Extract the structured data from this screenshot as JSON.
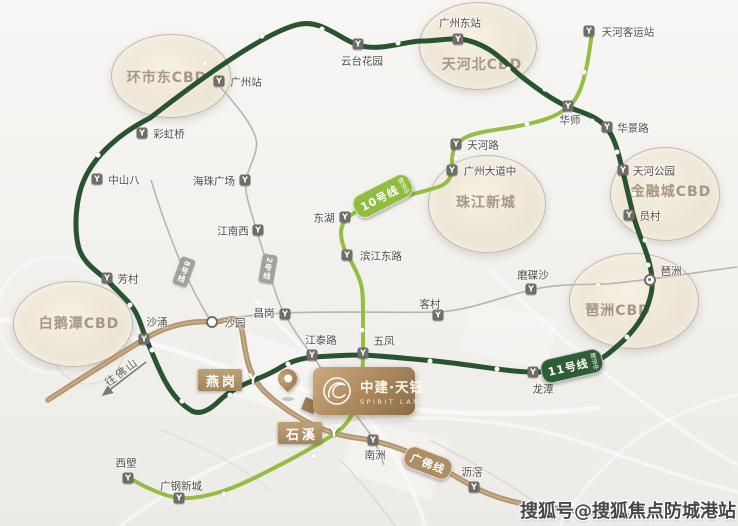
{
  "watermark": "搜狐号@搜狐焦点防城港站",
  "direction_label": "往佛山",
  "project": {
    "name_cn": "中建·天钰",
    "name_en": "SPIRIT LAND"
  },
  "colors": {
    "line_loop": "#2a5430",
    "line_light_green": "#96bd43",
    "line_brown": "#b29670",
    "line_brown_hi": "#cfb289",
    "line_gray": "#b7b5b1",
    "arrow_gray": "#7b7975",
    "zone_text": "#a89786",
    "station_icon_bg": "#6f6d68",
    "badge_line10_bg": "#8fbc41",
    "badge_line11_bg": "#2e5d36",
    "badge_guangfo_bg": "#ad8e64",
    "badge_gray_bg": "#a3a19d",
    "badge_station_bg": "#b29a6e"
  },
  "cbd_zones": [
    {
      "label": "环市东CBD",
      "cx": 170,
      "cy": 75,
      "rx": 59,
      "ry": 41,
      "lx": 167,
      "ly": 77
    },
    {
      "label": "天河北CBD",
      "cx": 477,
      "cy": 45,
      "rx": 58,
      "ry": 43,
      "lx": 482,
      "ly": 64
    },
    {
      "label": "珠江新城",
      "cx": 486,
      "cy": 203,
      "rx": 58,
      "ry": 48,
      "lx": 486,
      "ly": 202
    },
    {
      "label": "金融城CBD",
      "cx": 664,
      "cy": 193,
      "rx": 54,
      "ry": 46,
      "lx": 671,
      "ly": 191
    },
    {
      "label": "琶洲CBD",
      "cx": 633,
      "cy": 300,
      "rx": 64,
      "ry": 47,
      "lx": 618,
      "ly": 310
    },
    {
      "label": "白鹅潭CBD",
      "cx": 72,
      "cy": 323,
      "rx": 59,
      "ry": 42,
      "lx": 79,
      "ly": 323
    }
  ],
  "stations": [
    {
      "label": "广州站",
      "icon": "metro",
      "ix": 219,
      "iy": 81,
      "lx": 246,
      "ly": 82
    },
    {
      "label": "云台花园",
      "icon": "metro",
      "ix": 358,
      "iy": 44,
      "lx": 362,
      "ly": 61
    },
    {
      "label": "广州东站",
      "icon": "metro",
      "ix": 458,
      "iy": 39,
      "lx": 460,
      "ly": 23
    },
    {
      "label": "天河客运站",
      "icon": "metro",
      "ix": 589,
      "iy": 31,
      "lx": 628,
      "ly": 32
    },
    {
      "label": "华师",
      "icon": "metro",
      "ix": 568,
      "iy": 106,
      "lx": 570,
      "ly": 120
    },
    {
      "label": "华景路",
      "icon": "metro",
      "ix": 607,
      "iy": 127,
      "lx": 633,
      "ly": 128
    },
    {
      "label": "天河公园",
      "icon": "metro",
      "ix": 623,
      "iy": 170,
      "lx": 654,
      "ly": 171
    },
    {
      "label": "员村",
      "icon": "metro",
      "ix": 629,
      "iy": 215,
      "lx": 650,
      "ly": 216
    },
    {
      "label": "天河路",
      "icon": "metro",
      "ix": 456,
      "iy": 144,
      "lx": 483,
      "ly": 145
    },
    {
      "label": "广州大道中",
      "icon": "metro",
      "ix": 452,
      "iy": 170,
      "lx": 490,
      "ly": 171
    },
    {
      "label": "东湖",
      "icon": "metro",
      "ix": 345,
      "iy": 217,
      "lx": 324,
      "ly": 218
    },
    {
      "label": "滨江东路",
      "icon": "metro",
      "ix": 347,
      "iy": 255,
      "lx": 381,
      "ly": 256
    },
    {
      "label": "彩虹桥",
      "icon": "metro",
      "ix": 142,
      "iy": 133,
      "lx": 169,
      "ly": 134
    },
    {
      "label": "中山八",
      "icon": "metro",
      "ix": 97,
      "iy": 179,
      "lx": 124,
      "ly": 180
    },
    {
      "label": "海珠广场",
      "icon": "metro",
      "ix": 245,
      "iy": 180,
      "lx": 214,
      "ly": 181
    },
    {
      "label": "江南西",
      "icon": "metro",
      "ix": 258,
      "iy": 230,
      "lx": 233,
      "ly": 231
    },
    {
      "label": "芳村",
      "icon": "metro",
      "ix": 107,
      "iy": 278,
      "lx": 128,
      "ly": 279
    },
    {
      "label": "沙涌",
      "icon": "metro",
      "ix": 144,
      "iy": 339,
      "lx": 157,
      "ly": 322
    },
    {
      "label": "沙园",
      "icon": "ring",
      "ix": 212,
      "iy": 322,
      "lx": 235,
      "ly": 323
    },
    {
      "label": "昌岗",
      "icon": "metro",
      "ix": 285,
      "iy": 314,
      "lx": 264,
      "ly": 313
    },
    {
      "label": "江泰路",
      "icon": "metro",
      "ix": 312,
      "iy": 355,
      "lx": 321,
      "ly": 340
    },
    {
      "label": "五凤",
      "icon": "metro",
      "ix": 363,
      "iy": 353,
      "lx": 384,
      "ly": 341
    },
    {
      "label": "客村",
      "icon": "metro",
      "ix": 438,
      "iy": 315,
      "lx": 430,
      "ly": 304
    },
    {
      "label": "磨碟沙",
      "icon": "metro",
      "ix": 531,
      "iy": 289,
      "lx": 533,
      "ly": 275
    },
    {
      "label": "琶洲",
      "icon": "ring-dot",
      "ix": 650,
      "iy": 280,
      "lx": 671,
      "ly": 271
    },
    {
      "label": "龙潭",
      "icon": "metro",
      "ix": 533,
      "iy": 372,
      "lx": 543,
      "ly": 389
    },
    {
      "label": "南洲",
      "icon": "metro",
      "ix": 373,
      "iy": 440,
      "lx": 375,
      "ly": 455
    },
    {
      "label": "沥滘",
      "icon": "metro",
      "ix": 474,
      "iy": 487,
      "lx": 472,
      "ly": 472
    },
    {
      "label": "西塱",
      "icon": "metro",
      "ix": 128,
      "iy": 478,
      "lx": 126,
      "ly": 463
    },
    {
      "label": "广钢新城",
      "icon": "metro",
      "ix": 179,
      "iy": 498,
      "lx": 181,
      "ly": 486
    }
  ],
  "line_badges": [
    {
      "label": "10号线",
      "note": "建设中",
      "x": 383,
      "y": 196,
      "rot": -27,
      "bg": "#8fbc41",
      "type": "pill"
    },
    {
      "label": "11号线",
      "note": "建设中",
      "x": 572,
      "y": 366,
      "rot": -13,
      "bg": "#2e5d36",
      "type": "pill"
    },
    {
      "label": "广佛线",
      "note": "",
      "x": 428,
      "y": 463,
      "rot": 21,
      "bg": "#ad8e64",
      "type": "pill"
    },
    {
      "label": "8号线",
      "note": "",
      "x": 184,
      "y": 272,
      "rot": 20,
      "bg": "#a3a19d",
      "type": "vertical"
    },
    {
      "label": "2号线",
      "note": "",
      "x": 268,
      "y": 269,
      "rot": 10,
      "bg": "#a3a19d",
      "type": "vertical"
    }
  ],
  "station_badges": [
    {
      "label": "燕岗",
      "bx": 220,
      "by": 380,
      "icon_x": 253,
      "icon_y": 380
    },
    {
      "label": "石溪",
      "bx": 300,
      "by": 433,
      "icon_x": 334,
      "icon_y": 433
    }
  ]
}
